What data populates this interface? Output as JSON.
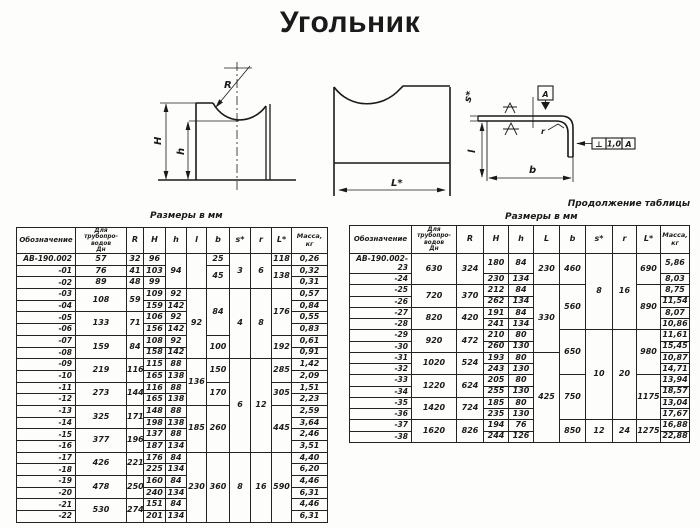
{
  "title": "Угольник",
  "captions": {
    "left_table": "Размеры в мм",
    "right_table": "Размеры в мм",
    "continuation": "Продолжение таблицы"
  },
  "drawings": {
    "front_view": {
      "radius_label": "R",
      "height_label": "H",
      "inner_height_label": "h"
    },
    "side_view": {
      "length_label": "L*"
    },
    "section_view": {
      "thickness_label": "s*",
      "leg_label": "l",
      "width_label": "b",
      "corner_radius_label": "r",
      "datum_label": "A",
      "tolerance_frame": {
        "symbol": "⊥",
        "value": "1,0",
        "datum": "A"
      }
    }
  },
  "tables": {
    "left": {
      "headers": [
        "Обозначение",
        "Для\nтрубопро-\nводов\nДн",
        "R",
        "H",
        "h",
        "l",
        "b",
        "s*",
        "r",
        "L*",
        "Масса,\nкг"
      ],
      "rows": [
        [
          "АВ-190.002",
          "57",
          "32",
          "96",
          [
            "94",
            3
          ],
          [
            "",
            3
          ],
          "25",
          [
            "3",
            3
          ],
          [
            "6",
            3
          ],
          "118",
          "0,26"
        ],
        [
          "-01",
          "76",
          "41",
          "103",
          [
            "45",
            2
          ],
          [
            "138",
            2
          ],
          "0,32"
        ],
        [
          "-02",
          "89",
          "48",
          "99",
          "0,31"
        ],
        [
          "-03",
          [
            "108",
            2
          ],
          [
            "59",
            2
          ],
          "109",
          "92",
          [
            "92",
            6
          ],
          [
            "84",
            4
          ],
          [
            "4",
            6
          ],
          [
            "8",
            6
          ],
          [
            "176",
            4
          ],
          "0,57"
        ],
        [
          "-04",
          "159",
          "142",
          "0,84"
        ],
        [
          "-05",
          [
            "133",
            2
          ],
          [
            "71",
            2
          ],
          "106",
          "92",
          "0,55"
        ],
        [
          "-06",
          "156",
          "142",
          "0,83"
        ],
        [
          "-07",
          [
            "159",
            2
          ],
          [
            "84",
            2
          ],
          "108",
          "92",
          [
            "100",
            2
          ],
          [
            "192",
            2
          ],
          "0,61"
        ],
        [
          "-08",
          "158",
          "142",
          "0,91"
        ],
        [
          "-09",
          [
            "219",
            2
          ],
          [
            "116",
            2
          ],
          "115",
          "88",
          [
            "136",
            4
          ],
          [
            "150",
            2
          ],
          [
            "6",
            8
          ],
          [
            "12",
            8
          ],
          [
            "285",
            2
          ],
          "1,42"
        ],
        [
          "-10",
          "165",
          "138",
          "2,09"
        ],
        [
          "-11",
          [
            "273",
            2
          ],
          [
            "144",
            2
          ],
          "116",
          "88",
          [
            "170",
            2
          ],
          [
            "305",
            2
          ],
          "1,51"
        ],
        [
          "-12",
          "165",
          "138",
          "2,23"
        ],
        [
          "-13",
          [
            "325",
            2
          ],
          [
            "171",
            2
          ],
          "148",
          "88",
          [
            "185",
            4
          ],
          [
            "260",
            4
          ],
          [
            "445",
            4
          ],
          "2,59"
        ],
        [
          "-14",
          "198",
          "138",
          "3,64"
        ],
        [
          "-15",
          [
            "377",
            2
          ],
          [
            "196",
            2
          ],
          "137",
          "88",
          "2,46"
        ],
        [
          "-16",
          "187",
          "134",
          "3,51"
        ],
        [
          "-17",
          [
            "426",
            2
          ],
          [
            "221",
            2
          ],
          "176",
          "84",
          [
            "230",
            6
          ],
          [
            "360",
            6
          ],
          [
            "8",
            6
          ],
          [
            "16",
            6
          ],
          [
            "590",
            6
          ],
          "4,40"
        ],
        [
          "-18",
          "225",
          "134",
          "6,20"
        ],
        [
          "-19",
          [
            "478",
            2
          ],
          [
            "250",
            2
          ],
          "160",
          "84",
          "4,46"
        ],
        [
          "-20",
          "240",
          "134",
          "6,31"
        ],
        [
          "-21",
          [
            "530",
            2
          ],
          [
            "274",
            2
          ],
          "151",
          "84",
          "4,46"
        ],
        [
          "-22",
          "201",
          "134",
          "6,31"
        ]
      ]
    },
    "right": {
      "headers": [
        "Обозначение",
        "Для\nтрубопро-\nводов\nДн",
        "R",
        "H",
        "h",
        "L",
        "b",
        "s*",
        "r",
        "L*",
        "Масса,\nкг"
      ],
      "rows": [
        [
          "АВ-190.002-23",
          [
            "630",
            2
          ],
          [
            "324",
            2
          ],
          "180",
          "84",
          [
            "230",
            2
          ],
          [
            "460",
            2
          ],
          [
            "8",
            6
          ],
          [
            "16",
            6
          ],
          [
            "690",
            2
          ],
          "5,86"
        ],
        [
          "-24",
          "230",
          "134",
          "8,03"
        ],
        [
          "-25",
          [
            "720",
            2
          ],
          [
            "370",
            2
          ],
          "212",
          "84",
          [
            "330",
            6
          ],
          [
            "560",
            4
          ],
          [
            "890",
            4
          ],
          "8,75"
        ],
        [
          "-26",
          "262",
          "134",
          "11,54"
        ],
        [
          "-27",
          [
            "820",
            2
          ],
          [
            "420",
            2
          ],
          "191",
          "84",
          "8,07"
        ],
        [
          "-28",
          "241",
          "134",
          "10,86"
        ],
        [
          "-29",
          [
            "920",
            2
          ],
          [
            "472",
            2
          ],
          "210",
          "80",
          [
            "650",
            4
          ],
          [
            "10",
            8
          ],
          [
            "20",
            8
          ],
          [
            "980",
            4
          ],
          "11,61"
        ],
        [
          "-30",
          "260",
          "130",
          "15,45"
        ],
        [
          "-31",
          [
            "1020",
            2
          ],
          [
            "524",
            2
          ],
          "193",
          "80",
          [
            "425",
            8
          ],
          "10,87"
        ],
        [
          "-32",
          "243",
          "130",
          "14,71"
        ],
        [
          "-33",
          [
            "1220",
            2
          ],
          [
            "624",
            2
          ],
          "205",
          "80",
          [
            "750",
            4
          ],
          [
            "1175",
            4
          ],
          "13,94"
        ],
        [
          "-34",
          "255",
          "130",
          "18,57"
        ],
        [
          "-35",
          [
            "1420",
            2
          ],
          [
            "724",
            2
          ],
          "185",
          "80",
          "13,04"
        ],
        [
          "-36",
          "235",
          "130",
          "17,67"
        ],
        [
          "-37",
          [
            "1620",
            2
          ],
          [
            "826",
            2
          ],
          "194",
          "76",
          [
            "850",
            2
          ],
          [
            "12",
            2
          ],
          [
            "24",
            2
          ],
          [
            "1275",
            2
          ],
          "16,88"
        ],
        [
          "-38",
          "244",
          "126",
          "22,88"
        ]
      ]
    }
  }
}
